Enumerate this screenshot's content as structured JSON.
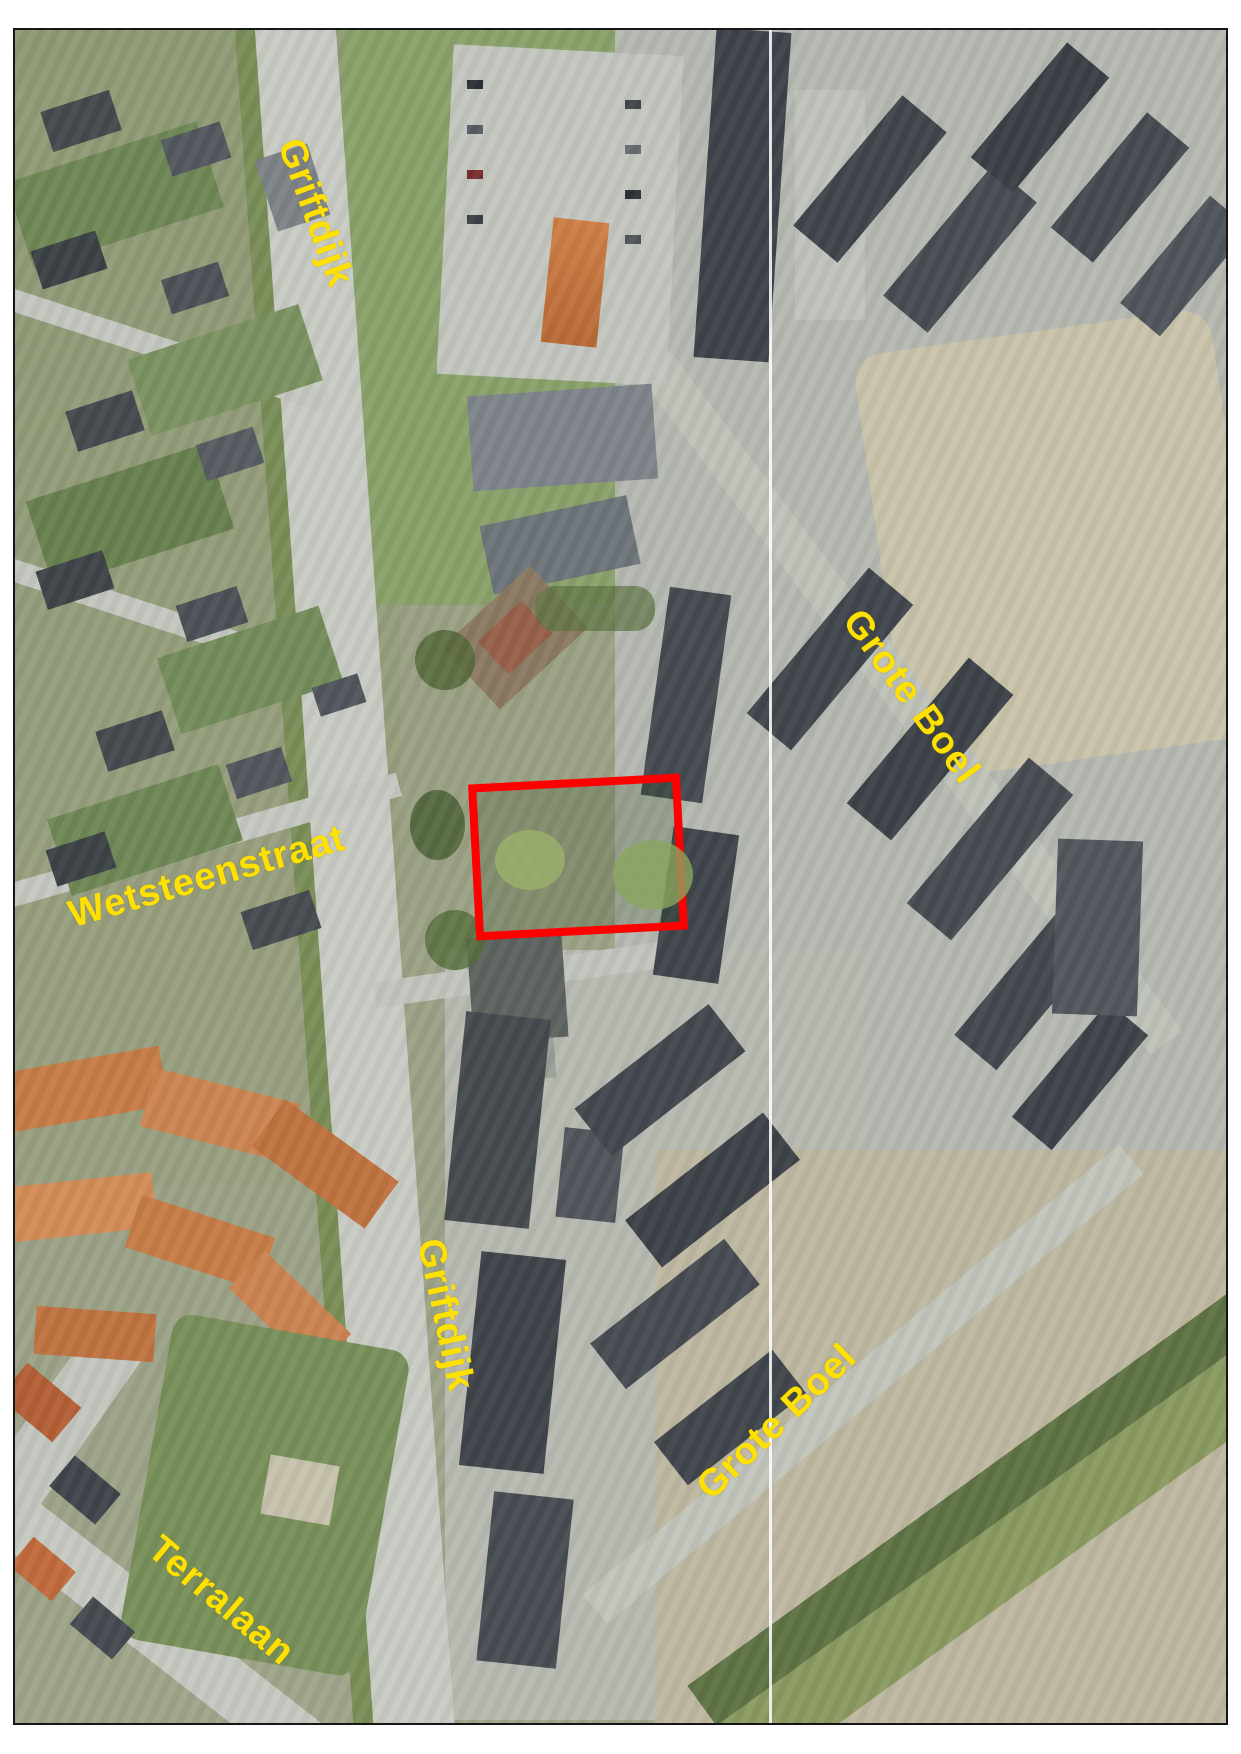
{
  "map": {
    "kind": "aerial-photo-with-street-annotations",
    "street_labels": [
      {
        "id": "griftdijk-top",
        "text": "Griftdijk"
      },
      {
        "id": "wetsteenstraat",
        "text": "Wetsteenstraat"
      },
      {
        "id": "grote-boel-upper",
        "text": "Grote Boel"
      },
      {
        "id": "griftdijk-middle",
        "text": "Griftdijk"
      },
      {
        "id": "grote-boel-lower",
        "text": "Grote Boel"
      },
      {
        "id": "terralaan",
        "text": "Terralaan"
      }
    ],
    "highlight": {
      "shape": "rectangle",
      "color": "#ff0000"
    },
    "colors": {
      "street_label": "#ffe100",
      "plot_outline": "#ff0000",
      "frame": "#161616"
    }
  }
}
